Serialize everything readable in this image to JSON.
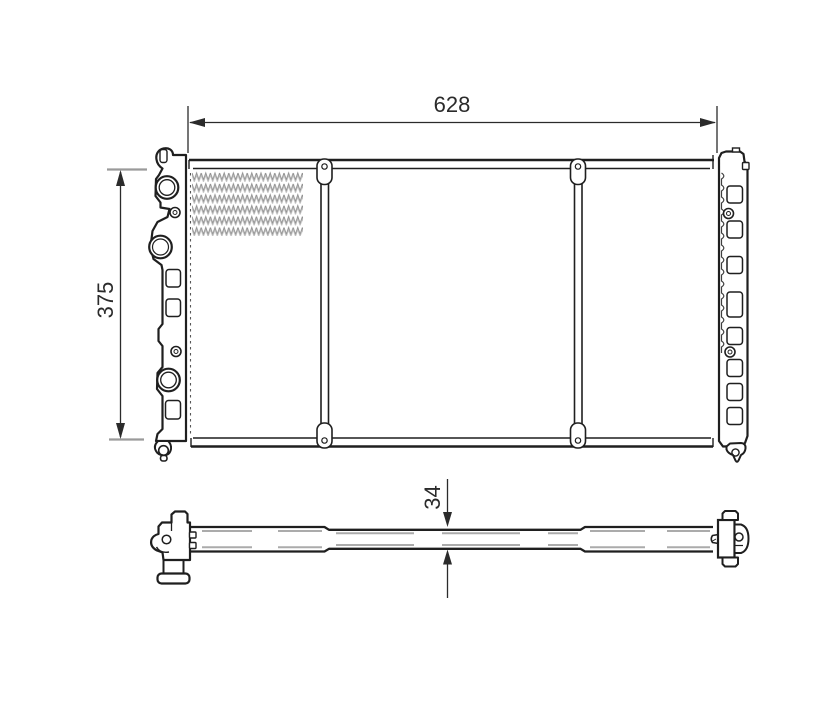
{
  "drawing": {
    "width_label": "628",
    "height_label": "375",
    "depth_label": "34"
  },
  "colors": {
    "bg": "#ffffff",
    "line": "#1f1f1f",
    "dim": "#2b2b2b",
    "tick": "#9a9a9a",
    "fin1": "#8f8f8f",
    "fin2": "#bdbdbd",
    "dash": "#ababab"
  }
}
